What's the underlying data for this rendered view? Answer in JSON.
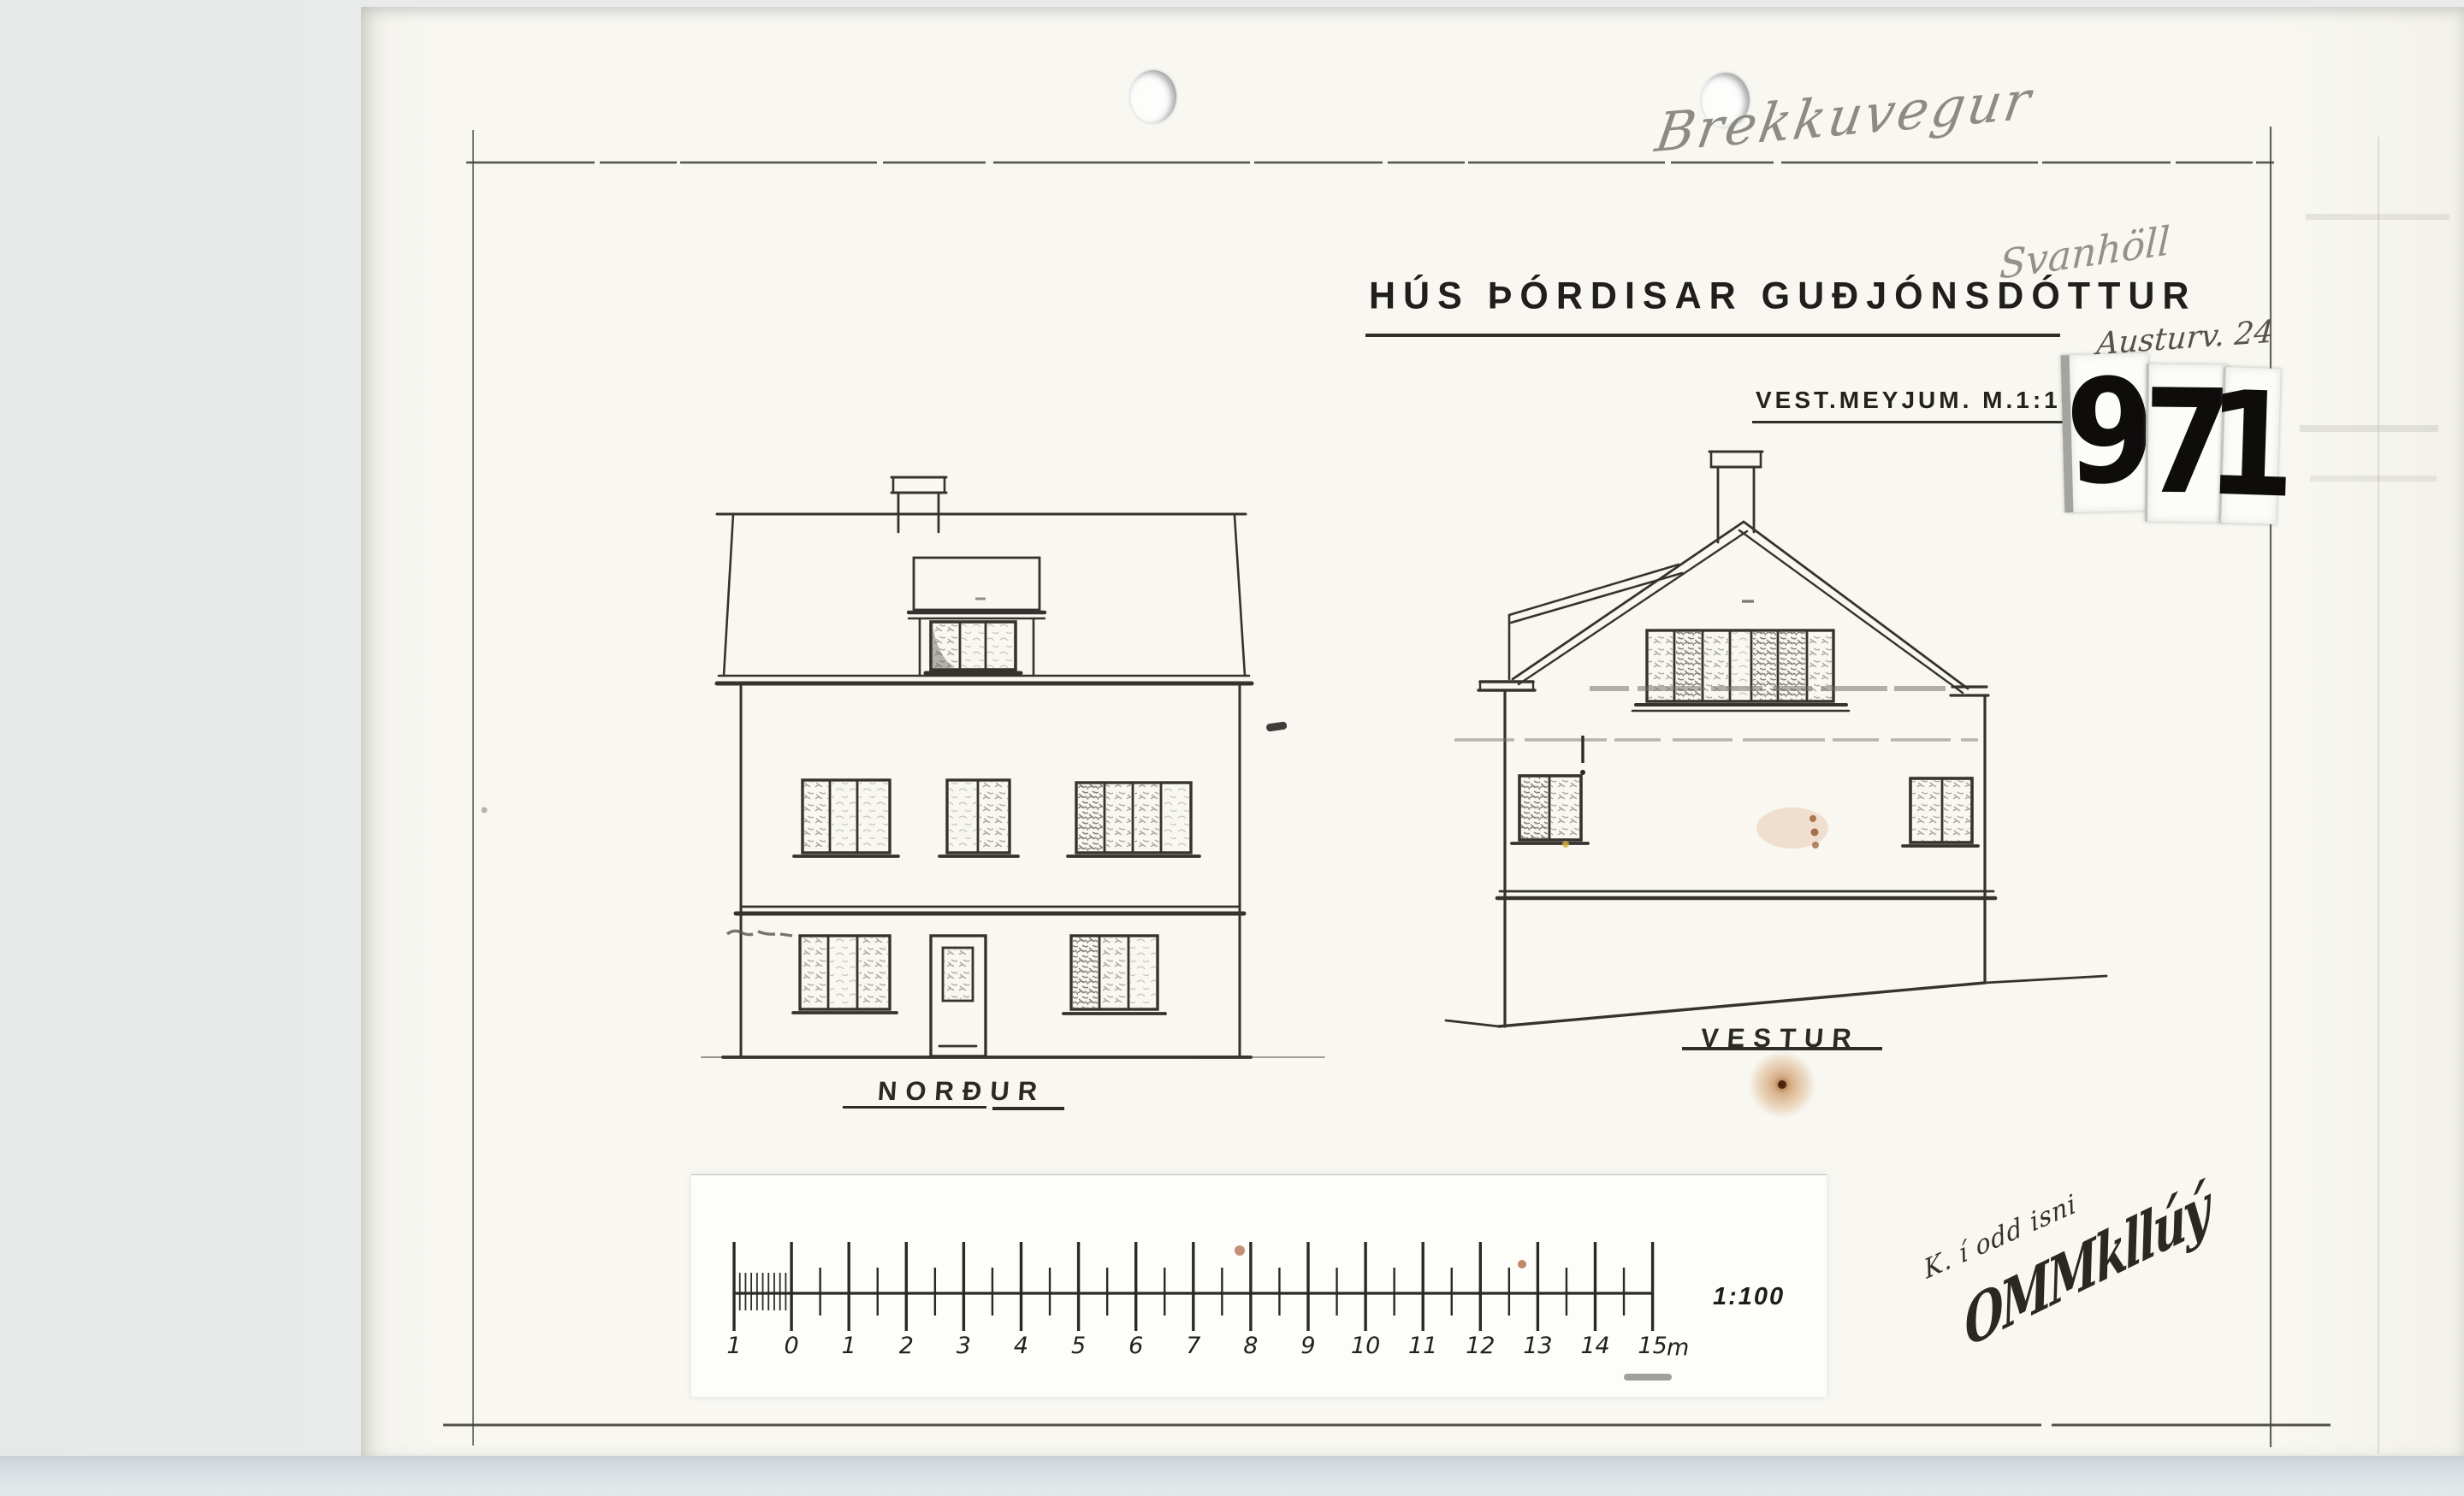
{
  "page": {
    "background": "#e8ebea",
    "paper": "#f8f7f2",
    "bottom_strip": "#dde4e7",
    "ink": "#35332e"
  },
  "document": {
    "title": "HÚS ÞÓRDISAR GUÐJÓNSDÓTTUR",
    "subtitle": "VEST.MEYJUM. M.1:100",
    "archive_number": [
      "9",
      "7",
      "1"
    ],
    "handwriting": {
      "top_line": "Brekkuvegur",
      "middle_line": "Svanhöll",
      "address": "Austurv. 24",
      "signature_small": "K. í odd isni",
      "signature_large": "OMMkllúý"
    },
    "elevations": [
      {
        "label": "NORÐUR"
      },
      {
        "label": "VESTUR"
      }
    ],
    "scale_bar": {
      "tick_labels": [
        "1",
        "0",
        "1",
        "2",
        "3",
        "4",
        "5",
        "6",
        "7",
        "8",
        "9",
        "10",
        "11",
        "12",
        "13",
        "14",
        "15"
      ],
      "unit": "m",
      "ratio": "1:100"
    }
  }
}
